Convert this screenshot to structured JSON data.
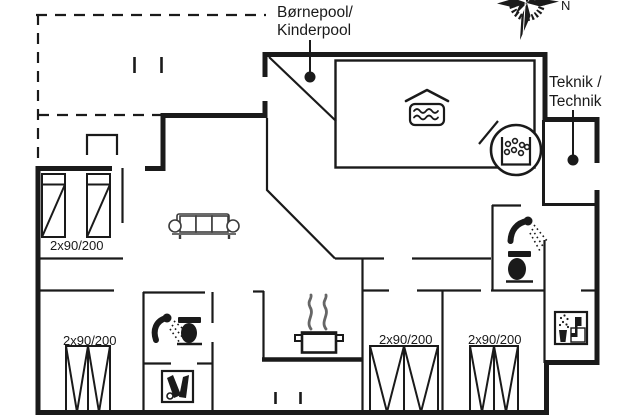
{
  "title": "Holiday home floor plan",
  "labels": {
    "kids_pool": {
      "line1": "Børnepool/",
      "line2": "Kinderpool"
    },
    "technics": {
      "line1": "Teknik /",
      "line2": "Technik"
    },
    "compass_north": "N"
  },
  "rooms": {
    "bedroom_top_left": {
      "bed_label": "2x90/200"
    },
    "bedroom_bottom_left": {
      "bed_label": "2x90/200"
    },
    "bedroom_bottom_middle": {
      "bed_label": "2x90/200"
    },
    "bedroom_bottom_right": {
      "bed_label": "2x90/200"
    }
  },
  "icons": {
    "compass-rose-icon": "compass rose with N marker, top right",
    "pool-icon": "swimming pool tub with waves and roof chevron",
    "kids-pool-marker": "black dot with leader line to kids pool corner",
    "technics-marker": "black dot with leader line inside technics room",
    "hot-tub-icon": "round whirlpool with bubble basket",
    "sofa-icon": "three-seat sofa, top view",
    "shower-icon": "shower head with spray (two bathrooms)",
    "toilet-icon": "black toilet, top view (two bathrooms)",
    "stove-pot-icon": "cooking pot with rising steam",
    "bottle-cabinet-icon": "boxed icon with two dark bottles and a circle",
    "utility-icon": "boxed icon with jug, spray dots and seat shape",
    "wardrobe-niche-icon": "open-bottom rectangle niche"
  },
  "colors": {
    "background": "#ffffff",
    "line": "#1a1a1a",
    "sofa": "#3c3c3c",
    "steam": "#666666"
  }
}
